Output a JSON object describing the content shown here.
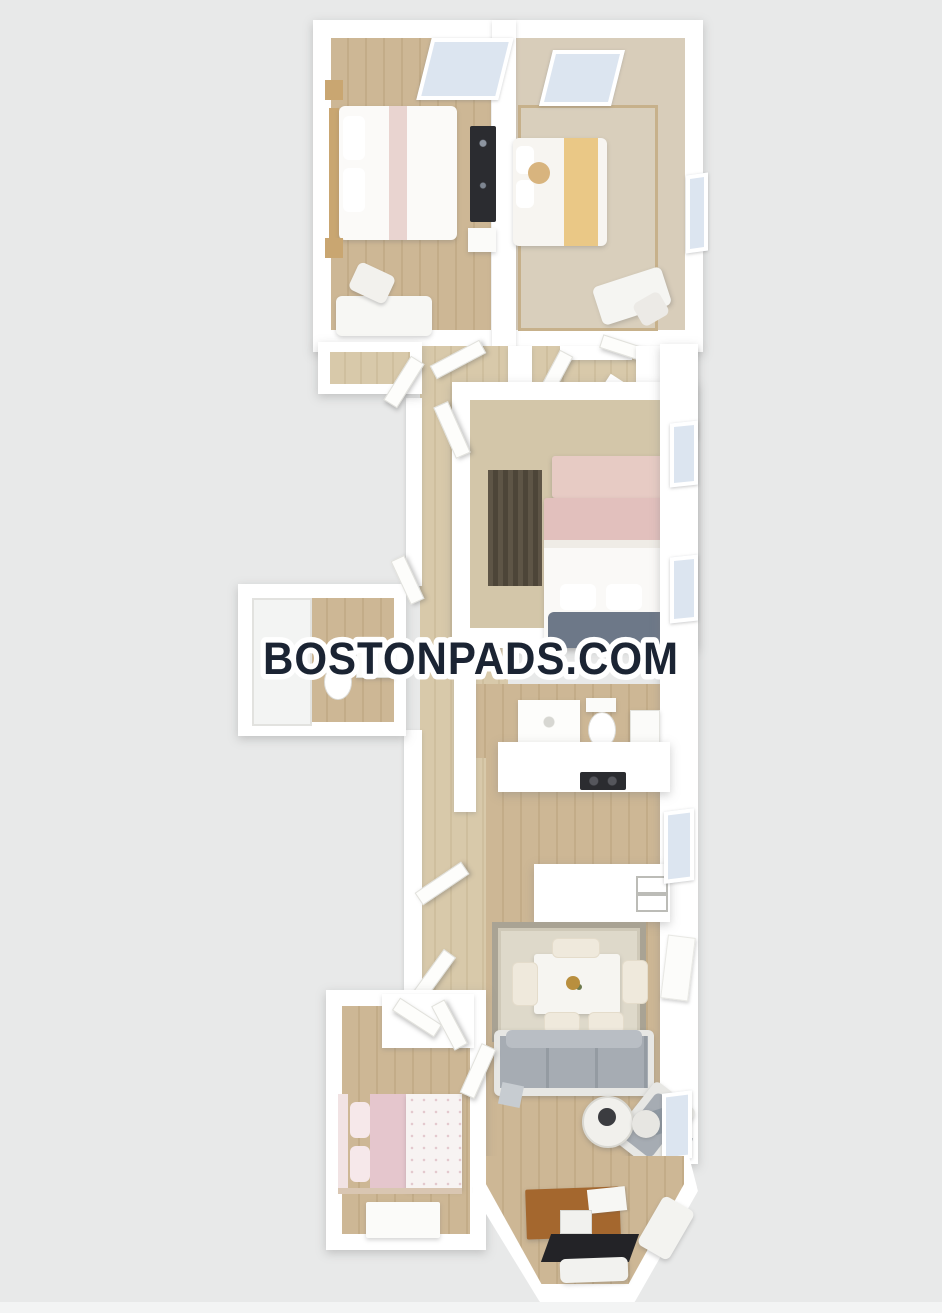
{
  "watermark": {
    "text": "BOSTONPADS.COM"
  },
  "palette": {
    "background": "#e8e9e9",
    "wall": "#ffffff",
    "wood": "#cdb795",
    "wood_light": "#d8c9aa",
    "carpet": "#d8cdba",
    "glass": "#dce5f0",
    "navy": "#1b2433",
    "yellow": "#eac886",
    "pink": "#e2c0bd",
    "pink_light": "#e5c6cd",
    "sofa_gray": "#a6acb3",
    "sofa_frame": "#e7e7e4",
    "dark_fixture": "#2b2c30",
    "closet_dark": "#574f40",
    "desk_brown": "#a4672e",
    "mat_black": "#232327",
    "rug_bg": "#ded9ca",
    "rug_border": "#a9a394"
  }
}
